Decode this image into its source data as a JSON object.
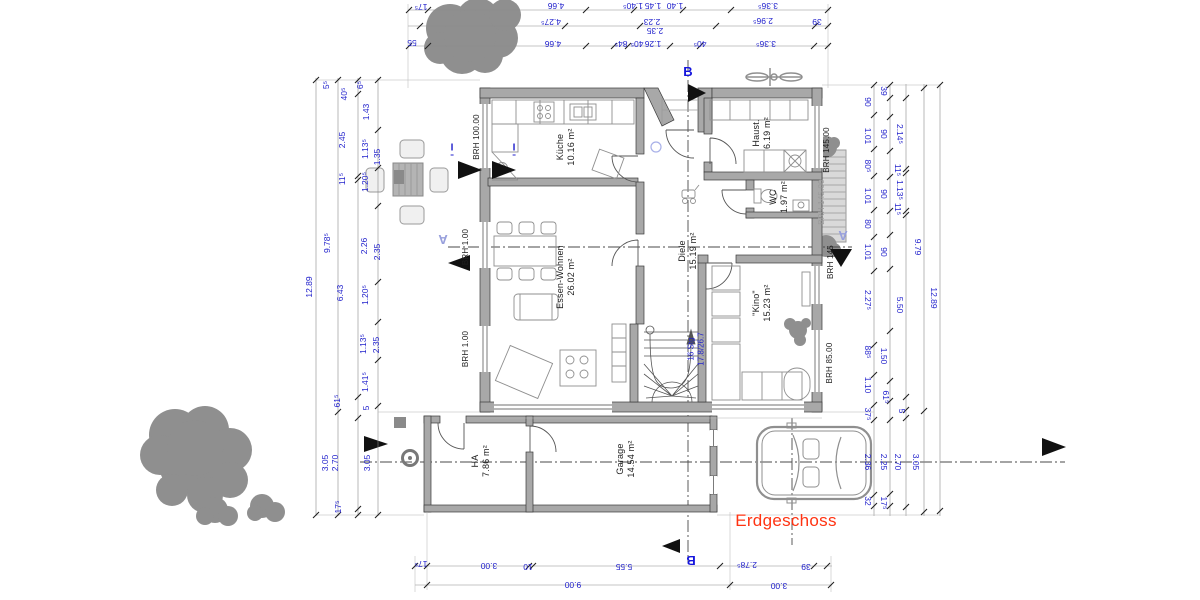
{
  "drawing": {
    "title": "Erdgeschoss",
    "title_color": "#ff3312"
  },
  "colors": {
    "dimension_text": "#2222cc",
    "walls": "#a8a8a8",
    "vegetation": "#8f8f8f",
    "section_marker": "#1515dd",
    "section_marker_light": "#98a0dc",
    "title": "#ff3312"
  },
  "rooms": [
    {
      "id": "kueche",
      "name": "Küche",
      "area": "10.16 m²",
      "x": 566,
      "y": 147
    },
    {
      "id": "haust",
      "name": "Haust.",
      "area": "6.19 m²",
      "x": 762,
      "y": 133
    },
    {
      "id": "wc",
      "name": "WC",
      "area": "1.97 m²",
      "x": 779,
      "y": 197
    },
    {
      "id": "diele",
      "name": "Diele",
      "area": "15.19 m²",
      "x": 688,
      "y": 251
    },
    {
      "id": "essen-wohnen",
      "name": "Essen-Wohnen",
      "area": "26.02 m²",
      "x": 566,
      "y": 277
    },
    {
      "id": "kino",
      "name": "\"Kino\"",
      "area": "15.23 m²",
      "x": 762,
      "y": 303
    },
    {
      "id": "ha",
      "name": "HA",
      "area": "7.86 m²",
      "x": 481,
      "y": 461
    },
    {
      "id": "garage",
      "name": "Garage",
      "area": "14.54 m²",
      "x": 626,
      "y": 459
    }
  ],
  "stair": {
    "text": "16 Stg\n17.8/26.7",
    "x": 696,
    "y": 349
  },
  "brh_labels": [
    {
      "t": "BRH 100.00",
      "x": 477,
      "y": 137
    },
    {
      "t": "BRH 1.00",
      "x": 466,
      "y": 247
    },
    {
      "t": "BRH 1.00",
      "x": 466,
      "y": 349
    },
    {
      "t": "BRH 145.00",
      "x": 827,
      "y": 150
    },
    {
      "t": "BRH 145.00",
      "x": 822,
      "y": 202,
      "gray": true
    },
    {
      "t": "BRH 145",
      "x": 831,
      "y": 262
    },
    {
      "t": "BRH 85.00",
      "x": 830,
      "y": 363
    }
  ],
  "section_markers": [
    {
      "t": "B",
      "x": 688,
      "y": 72,
      "rot": 0,
      "light": false
    },
    {
      "t": "B",
      "x": 691,
      "y": 560,
      "rot": 180,
      "light": false
    },
    {
      "t": "A",
      "x": 443,
      "y": 239,
      "rot": 180,
      "light": true
    },
    {
      "t": "A",
      "x": 843,
      "y": 235,
      "rot": 180,
      "light": true
    },
    {
      "t": "I",
      "x": 452,
      "y": 149,
      "rot": 0,
      "light": false,
      "imark": true
    },
    {
      "t": "I",
      "x": 514,
      "y": 149,
      "rot": 0,
      "light": false,
      "imark": true
    }
  ],
  "dimensions": {
    "left": [
      {
        "t": "12.89",
        "x": 309,
        "y": 287
      },
      {
        "t": "5⁵",
        "x": 326,
        "y": 85
      },
      {
        "t": "9.78⁵",
        "x": 327,
        "y": 243
      },
      {
        "t": "3.05",
        "x": 325,
        "y": 463
      },
      {
        "t": "40⁵",
        "x": 344,
        "y": 94
      },
      {
        "t": "2.45",
        "x": 342,
        "y": 140
      },
      {
        "t": "11⁵",
        "x": 342,
        "y": 179
      },
      {
        "t": "6.43",
        "x": 340,
        "y": 293
      },
      {
        "t": "61⁵",
        "x": 337,
        "y": 401
      },
      {
        "t": "2.70",
        "x": 335,
        "y": 463
      },
      {
        "t": "17⁵",
        "x": 338,
        "y": 507
      },
      {
        "t": "6⁵",
        "x": 360,
        "y": 85
      },
      {
        "t": "1.43",
        "x": 366,
        "y": 112
      },
      {
        "t": "1.13⁵",
        "x": 365,
        "y": 149
      },
      {
        "t": "1.20⁵",
        "x": 365,
        "y": 182
      },
      {
        "t": "2.26",
        "x": 364,
        "y": 246
      },
      {
        "t": "1.20⁵",
        "x": 365,
        "y": 295
      },
      {
        "t": "1.13⁵",
        "x": 363,
        "y": 344
      },
      {
        "t": "1.41⁵",
        "x": 365,
        "y": 382
      },
      {
        "t": "5",
        "x": 366,
        "y": 408
      },
      {
        "t": "3.05",
        "x": 367,
        "y": 463
      },
      {
        "t": "1.35",
        "x": 377,
        "y": 157
      },
      {
        "t": "2.35",
        "x": 377,
        "y": 252
      },
      {
        "t": "2.35",
        "x": 376,
        "y": 345
      }
    ],
    "right": [
      {
        "t": "90",
        "x": 868,
        "y": 102
      },
      {
        "t": "1.01",
        "x": 868,
        "y": 136
      },
      {
        "t": "80⁵",
        "x": 868,
        "y": 166
      },
      {
        "t": "1.01",
        "x": 868,
        "y": 196
      },
      {
        "t": "80",
        "x": 868,
        "y": 224
      },
      {
        "t": "1.01",
        "x": 868,
        "y": 252
      },
      {
        "t": "2.27⁵",
        "x": 868,
        "y": 300
      },
      {
        "t": "88⁵",
        "x": 868,
        "y": 352
      },
      {
        "t": "1.10",
        "x": 868,
        "y": 385
      },
      {
        "t": "37⁵",
        "x": 868,
        "y": 414
      },
      {
        "t": "2.36",
        "x": 868,
        "y": 462
      },
      {
        "t": "32",
        "x": 868,
        "y": 501
      },
      {
        "t": "39",
        "x": 884,
        "y": 91
      },
      {
        "t": "90",
        "x": 884,
        "y": 134
      },
      {
        "t": "90",
        "x": 884,
        "y": 194
      },
      {
        "t": "90",
        "x": 884,
        "y": 252
      },
      {
        "t": "1.50",
        "x": 884,
        "y": 356
      },
      {
        "t": "61⁵",
        "x": 886,
        "y": 397
      },
      {
        "t": "2.25",
        "x": 884,
        "y": 462
      },
      {
        "t": "17⁵",
        "x": 884,
        "y": 503
      },
      {
        "t": "2.14⁵",
        "x": 900,
        "y": 134
      },
      {
        "t": "11⁵",
        "x": 898,
        "y": 170
      },
      {
        "t": "1.13⁵",
        "x": 900,
        "y": 190
      },
      {
        "t": "11⁵",
        "x": 898,
        "y": 209
      },
      {
        "t": "5.50",
        "x": 900,
        "y": 305
      },
      {
        "t": "5",
        "x": 902,
        "y": 411
      },
      {
        "t": "2.70",
        "x": 898,
        "y": 462
      },
      {
        "t": "9.79",
        "x": 918,
        "y": 247
      },
      {
        "t": "3.05",
        "x": 916,
        "y": 462
      },
      {
        "t": "12.89",
        "x": 934,
        "y": 298
      }
    ],
    "top": [
      {
        "t": "17⁵",
        "x": 421,
        "y": 7
      },
      {
        "t": "4.66",
        "x": 556,
        "y": 6
      },
      {
        "t": "1.40⁵",
        "x": 633,
        "y": 6
      },
      {
        "t": "1.45",
        "x": 653,
        "y": 6
      },
      {
        "t": "1.40",
        "x": 675,
        "y": 6
      },
      {
        "t": "3.36⁵",
        "x": 768,
        "y": 6
      },
      {
        "t": "4.27⁵",
        "x": 551,
        "y": 22
      },
      {
        "t": "2.23",
        "x": 652,
        "y": 22
      },
      {
        "t": "2.96⁵",
        "x": 763,
        "y": 21
      },
      {
        "t": "39",
        "x": 817,
        "y": 22
      },
      {
        "t": "2.35",
        "x": 655,
        "y": 31
      },
      {
        "t": "55",
        "x": 412,
        "y": 43
      },
      {
        "t": "4.66",
        "x": 553,
        "y": 44
      },
      {
        "t": "84⁵",
        "x": 621,
        "y": 44
      },
      {
        "t": "40⁵",
        "x": 637,
        "y": 44
      },
      {
        "t": "1.26",
        "x": 653,
        "y": 44
      },
      {
        "t": "40⁵",
        "x": 700,
        "y": 44
      },
      {
        "t": "3.36⁵",
        "x": 766,
        "y": 44
      }
    ],
    "bottom": [
      {
        "t": "17⁵",
        "x": 421,
        "y": 564
      },
      {
        "t": "3.00",
        "x": 489,
        "y": 566
      },
      {
        "t": "10",
        "x": 528,
        "y": 567
      },
      {
        "t": "5.55",
        "x": 624,
        "y": 567
      },
      {
        "t": "2.78⁵",
        "x": 747,
        "y": 565
      },
      {
        "t": "39",
        "x": 806,
        "y": 567
      },
      {
        "t": "9.00",
        "x": 573,
        "y": 585
      },
      {
        "t": "3.00",
        "x": 779,
        "y": 586
      }
    ]
  }
}
